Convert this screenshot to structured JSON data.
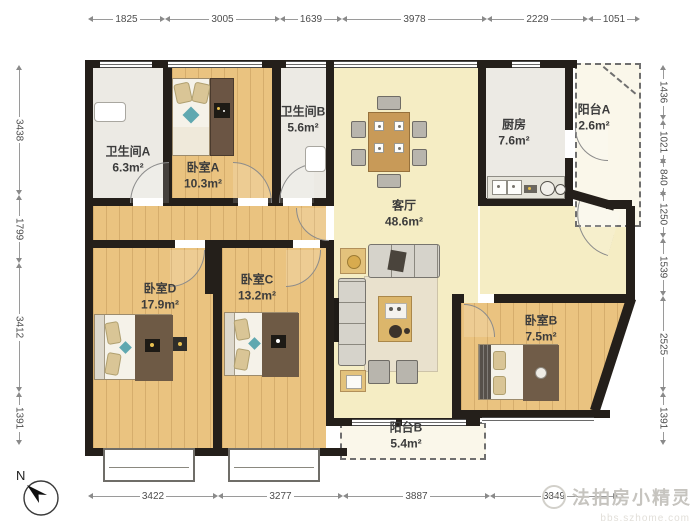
{
  "title": "apartment-floor-plan",
  "compass": {
    "label": "N"
  },
  "watermark": {
    "text": "法拍房小精灵",
    "subtext": "bbs.szhome.com"
  },
  "dimensions": {
    "top": [
      "1825",
      "3005",
      "1639",
      "3978",
      "2229",
      "1051"
    ],
    "bottom": [
      "3422",
      "3277",
      "3887",
      "3349"
    ],
    "left": [
      "3438",
      "1799",
      "3412",
      "1391"
    ],
    "right": [
      "1436",
      "1021",
      "840",
      "1250",
      "1539",
      "2525",
      "1391"
    ]
  },
  "rooms": [
    {
      "id": "bathroom-a",
      "name": "卫生间A",
      "area": "6.3m²"
    },
    {
      "id": "bedroom-a",
      "name": "卧室A",
      "area": "10.3m²"
    },
    {
      "id": "bathroom-b",
      "name": "卫生间B",
      "area": "5.6m²"
    },
    {
      "id": "living-room",
      "name": "客厅",
      "area": "48.6m²"
    },
    {
      "id": "kitchen",
      "name": "厨房",
      "area": "7.6m²"
    },
    {
      "id": "balcony-a",
      "name": "阳台A",
      "area": "2.6m²"
    },
    {
      "id": "bedroom-d",
      "name": "卧室D",
      "area": "17.9m²"
    },
    {
      "id": "bedroom-c",
      "name": "卧室C",
      "area": "13.2m²"
    },
    {
      "id": "bedroom-b",
      "name": "卧室B",
      "area": "7.5m²"
    },
    {
      "id": "balcony-b",
      "name": "阳台B",
      "area": "5.4m²"
    }
  ],
  "colors": {
    "wall": "#241f1a",
    "wood": "#eac380",
    "living": "#f5edc4",
    "tile": "#eceae4",
    "balcony": "#faf7ea"
  }
}
